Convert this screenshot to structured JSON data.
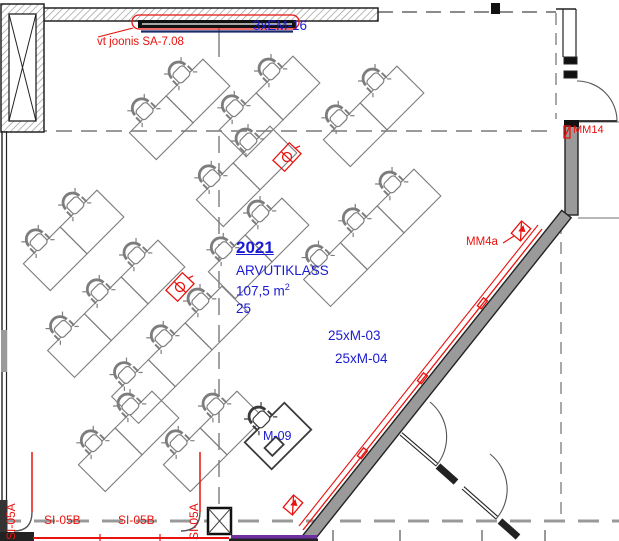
{
  "room": {
    "number": "2021",
    "name": "ARVUTIKLASS",
    "area_value": "107,5 m",
    "area_exponent": "2",
    "seat_count": "25"
  },
  "labels": {
    "circuit_em16": "3xEM-16",
    "ref_note": "vt joonis SA-7.08",
    "mm14": "MM14",
    "mm4a": "MM4a",
    "sockets_m03": "25xM-03",
    "sockets_m04": "25xM-04",
    "m09": "M-09",
    "tray_b1": "SI-05B",
    "tray_b2": "SI-05B",
    "riser_a1": "SI-05A",
    "riser_a2": "SI-05A"
  },
  "colors": {
    "annotation_blue": "#1b1bd2",
    "annotation_red": "#e8120e",
    "tray_purple": "#7030a0",
    "wall_gray": "#9a9a9a",
    "grid_gray": "#8c8c8c"
  }
}
